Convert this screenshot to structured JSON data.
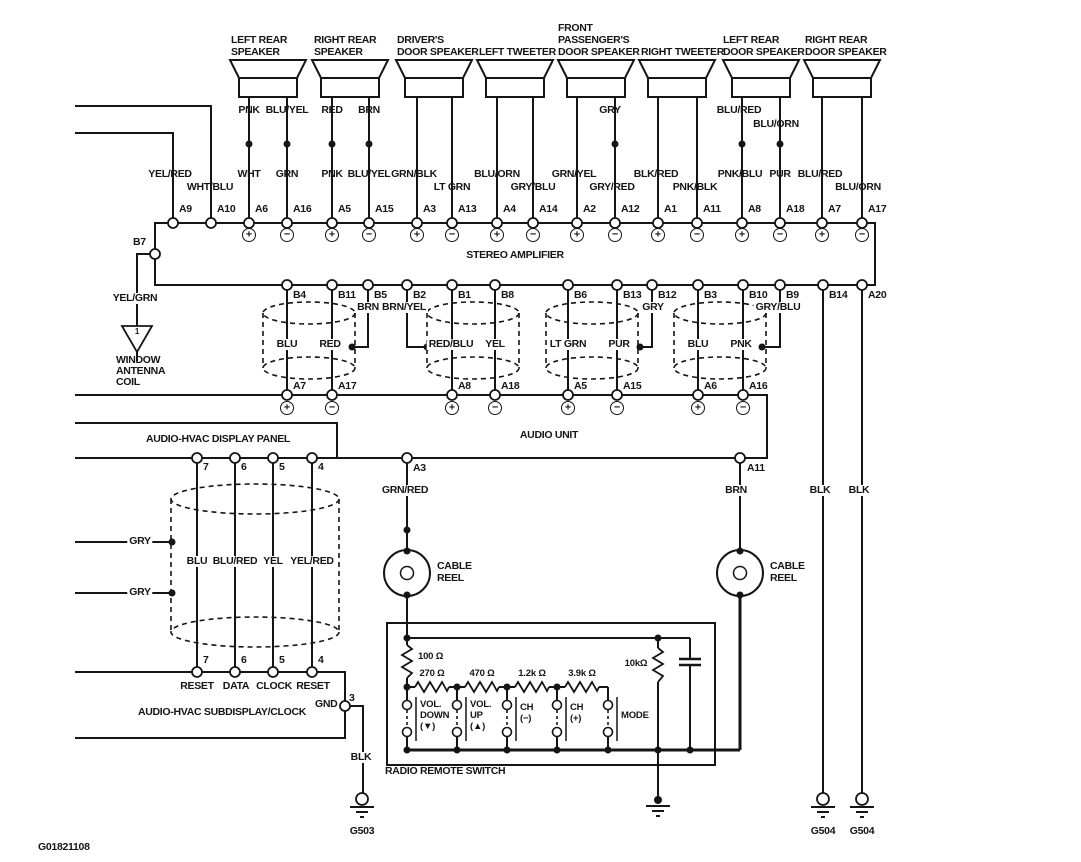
{
  "page": {
    "background": "#ffffff",
    "line_color": "#151515",
    "drawing_number": "G01821108"
  },
  "speakers": [
    {
      "lines": [
        "LEFT REAR",
        "SPEAKER"
      ]
    },
    {
      "lines": [
        "RIGHT REAR",
        "SPEAKER"
      ]
    },
    {
      "lines": [
        "DRIVER'S",
        "DOOR SPEAKER"
      ]
    },
    {
      "lines": [
        "LEFT TWEETER"
      ]
    },
    {
      "lines": [
        "FRONT",
        "PASSENGER'S",
        "DOOR SPEAKER"
      ]
    },
    {
      "lines": [
        "RIGHT TWEETER"
      ]
    },
    {
      "lines": [
        "LEFT REAR",
        "DOOR SPEAKER"
      ]
    },
    {
      "lines": [
        "RIGHT REAR",
        "DOOR SPEAKER"
      ]
    }
  ],
  "amplifier": {
    "label": "STEREO AMPLIFIER",
    "left_pin": "B7",
    "antenna_wire": "YEL/GRN",
    "antenna_symbol": "1",
    "antenna_lines": [
      "WINDOW",
      "ANTENNA",
      "COIL"
    ]
  },
  "amp_top_pins": [
    {
      "pin": "A9",
      "wire": "YEL/RED"
    },
    {
      "pin": "A10",
      "wire": "WHT/BLU"
    },
    {
      "pin": "A6",
      "wire": "WHT",
      "upper": "PNK",
      "polarity": "+"
    },
    {
      "pin": "A16",
      "wire": "GRN",
      "upper": "BLU/YEL",
      "polarity": "−"
    },
    {
      "pin": "A5",
      "wire": "PNK",
      "upper": "RED",
      "polarity": "+"
    },
    {
      "pin": "A15",
      "wire": "BLU/YEL",
      "upper": "BRN",
      "polarity": "−"
    },
    {
      "pin": "A3",
      "wire": "GRN/BLK",
      "polarity": "+"
    },
    {
      "pin": "A13",
      "wire": "LT GRN",
      "polarity": "−"
    },
    {
      "pin": "A4",
      "wire": "BLU/ORN",
      "polarity": "+"
    },
    {
      "pin": "A14",
      "wire": "GRY/BLU",
      "polarity": "−"
    },
    {
      "pin": "A2",
      "wire": "GRN/YEL",
      "polarity": "+"
    },
    {
      "pin": "A12",
      "wire": "GRY/RED",
      "upper": "GRY",
      "polarity": "−"
    },
    {
      "pin": "A1",
      "wire": "BLK/RED",
      "polarity": "+"
    },
    {
      "pin": "A11",
      "wire": "PNK/BLK",
      "polarity": "−"
    },
    {
      "pin": "A8",
      "wire": "PNK/BLU",
      "upper": "BLU/RED",
      "polarity": "+"
    },
    {
      "pin": "A18",
      "wire": "PUR",
      "upper": "BLU/ORN",
      "polarity": "−"
    },
    {
      "pin": "A7",
      "wire": "BLU/RED",
      "polarity": "+"
    },
    {
      "pin": "A17",
      "wire": "BLU/ORN",
      "polarity": "−"
    }
  ],
  "amp_bottom_pins": [
    "B4",
    "B11",
    "B5",
    "B2",
    "B1",
    "B8",
    "B6",
    "B13",
    "B12",
    "B3",
    "B10",
    "B9",
    "B14",
    "A20"
  ],
  "b_row_wires": [
    "BLU",
    "RED",
    "BRN",
    "BRN/YEL",
    "RED/BLU",
    "YEL",
    "LT GRN",
    "PUR",
    "GRY",
    "BLU",
    "PNK",
    "GRY/BLU"
  ],
  "audio_unit": {
    "label": "AUDIO UNIT",
    "top_pins": [
      {
        "pin": "A7",
        "polarity": "+"
      },
      {
        "pin": "A17",
        "polarity": "−"
      },
      {
        "pin": "A8",
        "polarity": "+"
      },
      {
        "pin": "A18",
        "polarity": "−"
      },
      {
        "pin": "A5",
        "polarity": "+"
      },
      {
        "pin": "A15",
        "polarity": "−"
      },
      {
        "pin": "A6",
        "polarity": "+"
      },
      {
        "pin": "A16",
        "polarity": "−"
      }
    ],
    "bottom_pins": [
      {
        "pin": "A3",
        "wire": "GRN/RED"
      },
      {
        "pin": "A11",
        "wire": "BRN"
      }
    ]
  },
  "ground_wires": [
    "BLK",
    "BLK"
  ],
  "display_panel": {
    "label": "AUDIO-HVAC DISPLAY PANEL",
    "pins": [
      "7",
      "6",
      "5",
      "4"
    ]
  },
  "shield_cable": {
    "wires": [
      "BLU",
      "BLU/RED",
      "YEL",
      "YEL/RED"
    ],
    "taps": [
      "GRY",
      "GRY"
    ]
  },
  "subdisplay": {
    "label": "AUDIO-HVAC SUBDISPLAY/CLOCK",
    "pins": [
      {
        "num": "7",
        "name": "RESET"
      },
      {
        "num": "6",
        "name": "DATA"
      },
      {
        "num": "5",
        "name": "CLOCK"
      },
      {
        "num": "4",
        "name": "RESET"
      }
    ],
    "gnd": {
      "label": "GND",
      "pin": "3",
      "wire": "BLK"
    }
  },
  "cable_reel": {
    "lines": [
      "CABLE",
      "REEL"
    ]
  },
  "remote_switch": {
    "label": "RADIO REMOTE SWITCH",
    "resistors": [
      "100 Ω",
      "270 Ω",
      "470 Ω",
      "1.2k Ω",
      "3.9k Ω",
      "10kΩ"
    ],
    "switches": [
      {
        "lines": [
          "VOL.",
          "DOWN",
          "(▼)"
        ]
      },
      {
        "lines": [
          "VOL.",
          "UP",
          "(▲)"
        ]
      },
      {
        "lines": [
          "CH",
          "(−)"
        ]
      },
      {
        "lines": [
          "CH",
          "(+)"
        ]
      },
      {
        "lines": [
          "MODE"
        ]
      }
    ]
  },
  "grounds": {
    "g503": "G503",
    "g504_a": "G504",
    "g504_b": "G504"
  }
}
